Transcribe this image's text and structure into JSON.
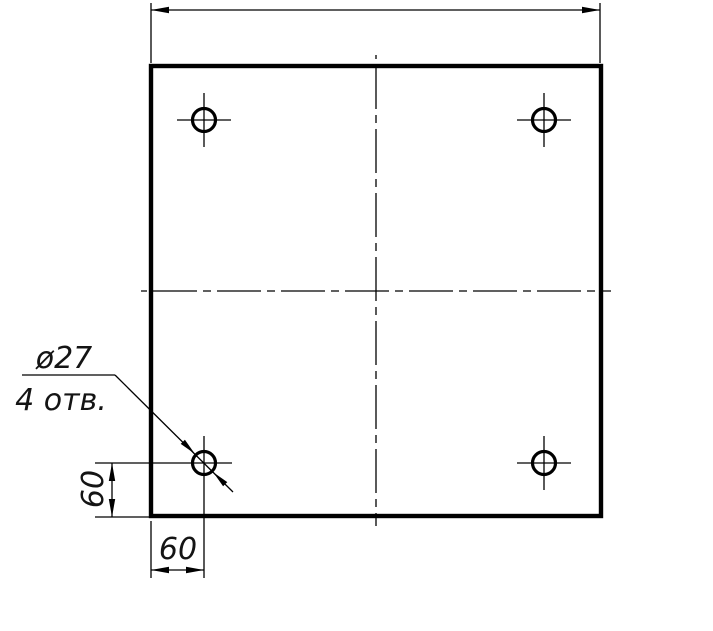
{
  "drawing": {
    "kind": "engineering-drawing",
    "description": "Square plate, front view, four drilled holes with centerlines",
    "background_color": "#ffffff",
    "line_color": "#000000",
    "annotations": {
      "hole_diameter_label": "ø27",
      "hole_count_label": "4 отв.",
      "dim_left_value": "60",
      "dim_bottom_value": "60",
      "dim_top_value": ""
    }
  }
}
